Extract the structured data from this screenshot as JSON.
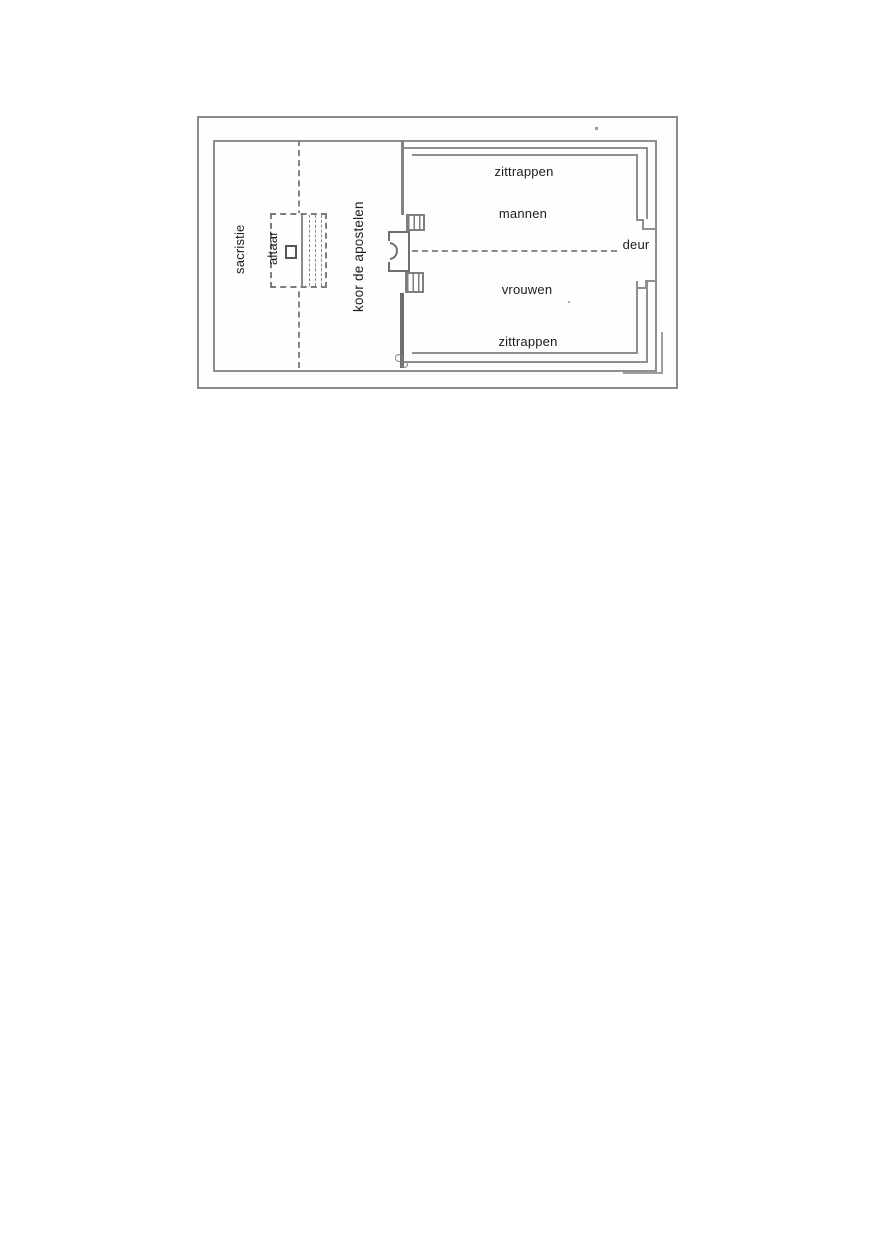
{
  "figure": {
    "type": "church-floor-plan-scan",
    "labels": {
      "sacristie": "sacristie",
      "altaar": "altaar",
      "koor_de_apostelen": "koor de apostelen",
      "zittrappen_top": "zittrappen",
      "mannen": "mannen",
      "deur": "deur",
      "vrouwen": "vrouwen",
      "zittrappen_bottom": "zittrappen"
    },
    "colors": {
      "frame_border": "#8c8c8c",
      "plan_line": "#8f8f8f",
      "text": "#1c1c1c",
      "background": "#ffffff"
    }
  }
}
